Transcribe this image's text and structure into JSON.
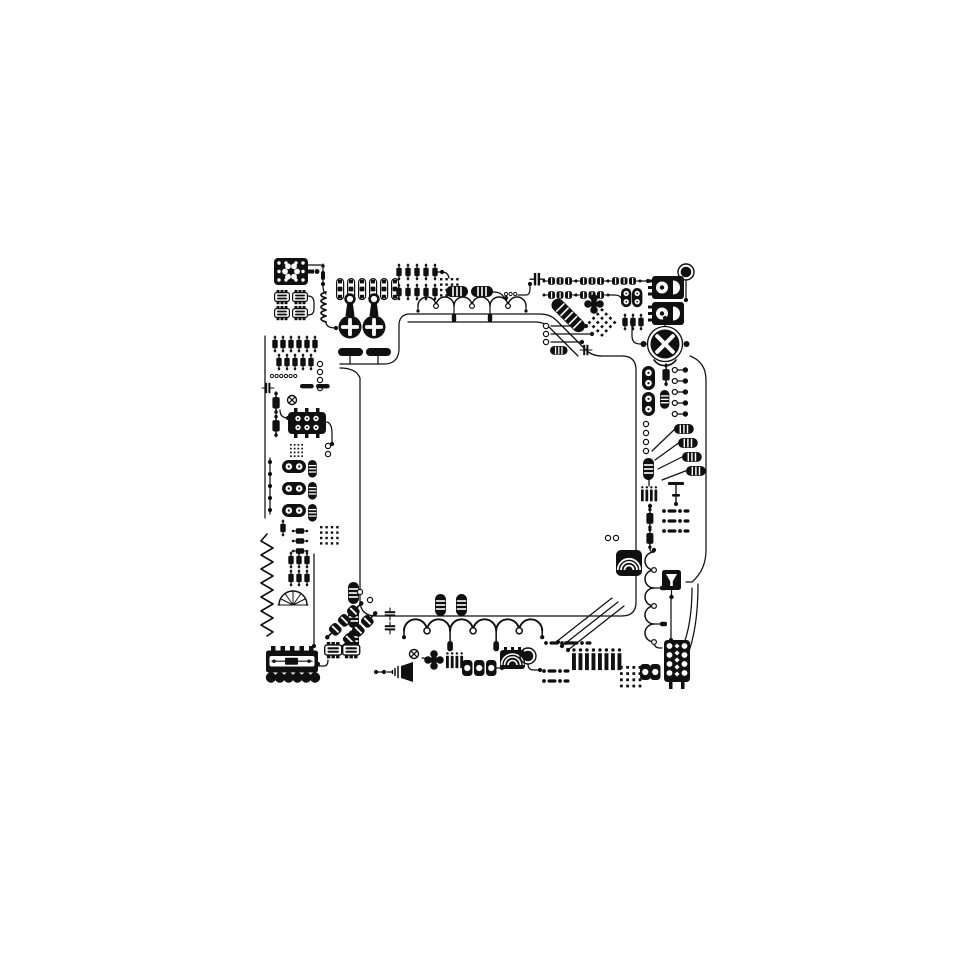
{
  "colors": {
    "ink": "#101010",
    "background": "#ffffff"
  },
  "diagram": {
    "frame": {
      "left": 256,
      "top": 252,
      "width": 456,
      "height": 448
    },
    "viewbox": "0 0 456 448",
    "components": [
      {
        "t": "ic-flower",
        "x": 18,
        "y": 6
      },
      {
        "t": "ic-small",
        "x": 18,
        "y": 38
      },
      {
        "t": "ic-small",
        "x": 36,
        "y": 38
      },
      {
        "t": "ic-small",
        "x": 18,
        "y": 54
      },
      {
        "t": "ic-small",
        "x": 36,
        "y": 54
      },
      {
        "t": "needle",
        "x": 64,
        "y": 12
      },
      {
        "t": "coil-v",
        "x": 62,
        "y": 40
      },
      {
        "t": "pin-pill",
        "x": 80,
        "y": 26
      },
      {
        "t": "pin-pill",
        "x": 91,
        "y": 26
      },
      {
        "t": "pin-pill",
        "x": 102,
        "y": 26
      },
      {
        "t": "pin-pill",
        "x": 113,
        "y": 26
      },
      {
        "t": "pin-pill",
        "x": 124,
        "y": 26
      },
      {
        "t": "pin-pill",
        "x": 135,
        "y": 26
      },
      {
        "t": "key-cross",
        "x": 86,
        "y": 42
      },
      {
        "t": "key-cross",
        "x": 110,
        "y": 42
      },
      {
        "t": "bar-h",
        "x": 82,
        "y": 96
      },
      {
        "t": "bar-h",
        "x": 110,
        "y": 96
      },
      {
        "t": "res-v",
        "x": 140,
        "y": 12
      },
      {
        "t": "res-v",
        "x": 149,
        "y": 12
      },
      {
        "t": "res-v",
        "x": 158,
        "y": 12
      },
      {
        "t": "res-v",
        "x": 167,
        "y": 12
      },
      {
        "t": "res-v",
        "x": 176,
        "y": 12
      },
      {
        "t": "res-v",
        "x": 140,
        "y": 32
      },
      {
        "t": "res-v",
        "x": 149,
        "y": 32
      },
      {
        "t": "res-v",
        "x": 158,
        "y": 32
      },
      {
        "t": "res-v",
        "x": 167,
        "y": 32
      },
      {
        "t": "res-v",
        "x": 176,
        "y": 32
      },
      {
        "t": "dot-grid",
        "x": 184,
        "y": 26
      },
      {
        "t": "pill-striped-h",
        "x": 190,
        "y": 34
      },
      {
        "t": "pill-striped-h",
        "x": 215,
        "y": 34
      },
      {
        "t": "wave6",
        "x": 162,
        "y": 44
      },
      {
        "t": "coo",
        "x": 250,
        "y": 42
      },
      {
        "t": "cap-h",
        "x": 274,
        "y": 20,
        "s": 1.2
      },
      {
        "t": "diode-chain",
        "x": 288,
        "y": 24
      },
      {
        "t": "diode-chain",
        "x": 320,
        "y": 24
      },
      {
        "t": "diode-chain",
        "x": 352,
        "y": 24
      },
      {
        "t": "diode-chain",
        "x": 288,
        "y": 38
      },
      {
        "t": "diode-chain",
        "x": 320,
        "y": 38
      },
      {
        "t": "clover5",
        "x": 338,
        "y": 52
      },
      {
        "t": "diag-cable",
        "x": 302,
        "y": 44,
        "r": 45
      },
      {
        "t": "dot-grid",
        "x": 346,
        "y": 56,
        "r": 45,
        "s": 1.1
      },
      {
        "t": "eight-v",
        "x": 365,
        "y": 36,
        "s": 0.8
      },
      {
        "t": "eight-v",
        "x": 376,
        "y": 36,
        "s": 0.8
      },
      {
        "t": "res-v",
        "x": 366,
        "y": 62
      },
      {
        "t": "res-v",
        "x": 374,
        "y": 62
      },
      {
        "t": "res-v",
        "x": 382,
        "y": 62
      },
      {
        "t": "ic-halfmoon",
        "x": 396,
        "y": 24
      },
      {
        "t": "ic-halfmoon",
        "x": 396,
        "y": 50
      },
      {
        "t": "big-dot",
        "x": 430,
        "y": 20
      },
      {
        "t": "ring",
        "x": 290,
        "y": 74
      },
      {
        "t": "ring",
        "x": 290,
        "y": 82
      },
      {
        "t": "ring",
        "x": 290,
        "y": 90
      },
      {
        "t": "pill-striped-h",
        "x": 294,
        "y": 94,
        "s": 0.8
      },
      {
        "t": "cap-h",
        "x": 324,
        "y": 92
      },
      {
        "t": "big-x",
        "x": 409,
        "y": 92
      },
      {
        "t": "ring-dot",
        "x": 416,
        "y": 114
      },
      {
        "t": "ring-dot",
        "x": 416,
        "y": 125
      },
      {
        "t": "ring-dot",
        "x": 416,
        "y": 136
      },
      {
        "t": "ring-dot",
        "x": 416,
        "y": 147
      },
      {
        "t": "ring-dot",
        "x": 416,
        "y": 158
      },
      {
        "t": "res-v",
        "x": 406,
        "y": 112,
        "s": 1.35
      },
      {
        "t": "pill-striped-v",
        "x": 404,
        "y": 138,
        "s": 0.85
      },
      {
        "t": "eight-v",
        "x": 386,
        "y": 114
      },
      {
        "t": "eight-v",
        "x": 386,
        "y": 140
      },
      {
        "t": "pill-striped-h",
        "x": 418,
        "y": 172,
        "s": 0.9
      },
      {
        "t": "pill-striped-h",
        "x": 422,
        "y": 186,
        "s": 0.9
      },
      {
        "t": "pill-striped-h",
        "x": 426,
        "y": 200,
        "s": 0.9
      },
      {
        "t": "pill-striped-h",
        "x": 430,
        "y": 214,
        "s": 0.9
      },
      {
        "t": "ring",
        "x": 390,
        "y": 172
      },
      {
        "t": "ring",
        "x": 390,
        "y": 181
      },
      {
        "t": "ring",
        "x": 390,
        "y": 190
      },
      {
        "t": "ring",
        "x": 390,
        "y": 199
      },
      {
        "t": "pill-striped-v",
        "x": 387,
        "y": 206
      },
      {
        "t": "stripes-v",
        "x": 385,
        "y": 234,
        "s": 0.9
      },
      {
        "t": "res-v",
        "x": 390,
        "y": 256,
        "s": 1.3
      },
      {
        "t": "res-v",
        "x": 390,
        "y": 276,
        "s": 1.3
      },
      {
        "t": "dash-dot-row",
        "x": 406,
        "y": 256
      },
      {
        "t": "dash-dot-row",
        "x": 406,
        "y": 266
      },
      {
        "t": "dash-dot-row",
        "x": 406,
        "y": 276
      },
      {
        "t": "cap-t",
        "x": 412,
        "y": 230
      },
      {
        "t": "wave5v",
        "x": 388,
        "y": 300
      },
      {
        "t": "shell",
        "x": 360,
        "y": 298
      },
      {
        "t": "ring",
        "x": 352,
        "y": 286
      },
      {
        "t": "ring",
        "x": 360,
        "y": 286
      },
      {
        "t": "funnel-ic",
        "x": 406,
        "y": 318
      },
      {
        "t": "relay-v",
        "x": 406,
        "y": 388
      },
      {
        "t": "zigzag-v",
        "x": 4,
        "y": 282
      },
      {
        "t": "res-v",
        "x": 32,
        "y": 300
      },
      {
        "t": "res-v",
        "x": 40,
        "y": 300
      },
      {
        "t": "res-v",
        "x": 48,
        "y": 300
      },
      {
        "t": "res-v",
        "x": 32,
        "y": 318
      },
      {
        "t": "res-v",
        "x": 40,
        "y": 318
      },
      {
        "t": "res-v",
        "x": 48,
        "y": 318
      },
      {
        "t": "semicircle-fan",
        "x": 22,
        "y": 336
      },
      {
        "t": "res-v",
        "x": 52,
        "y": 276,
        "r": 90
      },
      {
        "t": "res-v",
        "x": 52,
        "y": 286,
        "r": 90
      },
      {
        "t": "res-v",
        "x": 52,
        "y": 296,
        "r": 90
      },
      {
        "t": "pill-striped-v",
        "x": 92,
        "y": 330
      },
      {
        "t": "pill-striped-v",
        "x": 92,
        "y": 354
      },
      {
        "t": "pill-striped-v",
        "x": 92,
        "y": 378
      },
      {
        "t": "diode-chain",
        "x": 66,
        "y": 380,
        "r": -45,
        "s": 1.5
      },
      {
        "t": "diode-chain",
        "x": 80,
        "y": 390,
        "r": -45,
        "s": 1.5
      },
      {
        "t": "ring",
        "x": 104,
        "y": 340
      },
      {
        "t": "ring",
        "x": 114,
        "y": 348
      },
      {
        "t": "ic-small",
        "x": 68,
        "y": 390,
        "s": 1.15
      },
      {
        "t": "ic-small",
        "x": 86,
        "y": 390,
        "s": 1.15
      },
      {
        "t": "connector",
        "x": 10,
        "y": 394
      },
      {
        "t": "dot",
        "x": 128,
        "y": 420
      },
      {
        "t": "horn",
        "x": 136,
        "y": 410
      },
      {
        "t": "cap-h",
        "x": 140,
        "y": 356,
        "r": 90
      },
      {
        "t": "cap-h",
        "x": 140,
        "y": 370,
        "r": 90
      },
      {
        "t": "wave6",
        "x": 148,
        "y": 366,
        "s": 1.28
      },
      {
        "t": "pill-striped-v",
        "x": 179,
        "y": 342
      },
      {
        "t": "pill-striped-v",
        "x": 200,
        "y": 342
      },
      {
        "t": "x-ring",
        "x": 158,
        "y": 402
      },
      {
        "t": "clover5",
        "x": 178,
        "y": 408
      },
      {
        "t": "stripes-v",
        "x": 190,
        "y": 400,
        "s": 0.95
      },
      {
        "t": "oval-unit",
        "x": 206,
        "y": 408
      },
      {
        "t": "oval-unit",
        "x": 218,
        "y": 408
      },
      {
        "t": "oval-unit",
        "x": 230,
        "y": 408
      },
      {
        "t": "arc-box",
        "x": 244,
        "y": 398
      },
      {
        "t": "big-dot",
        "x": 272,
        "y": 404
      },
      {
        "t": "dash-dot-row",
        "x": 286,
        "y": 416
      },
      {
        "t": "dash-dot-row",
        "x": 286,
        "y": 426
      },
      {
        "t": "dash-dot-row",
        "x": 288,
        "y": 388
      },
      {
        "t": "dash-dot-row",
        "x": 308,
        "y": 388
      },
      {
        "t": "stripes-v",
        "x": 316,
        "y": 396,
        "s": 1.3
      },
      {
        "t": "stripes-v",
        "x": 342,
        "y": 396,
        "s": 1.3
      },
      {
        "t": "dot-grid",
        "x": 364,
        "y": 414,
        "s": 1.15
      },
      {
        "t": "oval-unit",
        "x": 384,
        "y": 412
      },
      {
        "t": "oval-unit",
        "x": 394,
        "y": 412
      },
      {
        "t": "res-v",
        "x": 16,
        "y": 84
      },
      {
        "t": "res-v",
        "x": 24,
        "y": 84
      },
      {
        "t": "res-v",
        "x": 32,
        "y": 84
      },
      {
        "t": "res-v",
        "x": 40,
        "y": 84
      },
      {
        "t": "res-v",
        "x": 48,
        "y": 84
      },
      {
        "t": "res-v",
        "x": 56,
        "y": 84
      },
      {
        "t": "res-v",
        "x": 20,
        "y": 102
      },
      {
        "t": "res-v",
        "x": 28,
        "y": 102
      },
      {
        "t": "res-v",
        "x": 36,
        "y": 102
      },
      {
        "t": "res-v",
        "x": 44,
        "y": 102
      },
      {
        "t": "res-v",
        "x": 52,
        "y": 102
      },
      {
        "t": "ring",
        "x": 64,
        "y": 112
      },
      {
        "t": "ring",
        "x": 64,
        "y": 120
      },
      {
        "t": "ring",
        "x": 64,
        "y": 128
      },
      {
        "t": "ring",
        "x": 64,
        "y": 136
      },
      {
        "t": "coo",
        "x": 16,
        "y": 124
      },
      {
        "t": "coo",
        "x": 30,
        "y": 124
      },
      {
        "t": "cap-h",
        "x": 6,
        "y": 130
      },
      {
        "t": "bar-h",
        "x": 44,
        "y": 132,
        "s": 0.55
      },
      {
        "t": "bar-h",
        "x": 60,
        "y": 132,
        "s": 0.55
      },
      {
        "t": "x-ring",
        "x": 36,
        "y": 148
      },
      {
        "t": "res-v",
        "x": 16,
        "y": 140,
        "s": 1.35
      },
      {
        "t": "res-v",
        "x": 16,
        "y": 163,
        "s": 1.35
      },
      {
        "t": "relay-h",
        "x": 32,
        "y": 158
      },
      {
        "t": "dot-grid",
        "x": 34,
        "y": 192,
        "s": 0.7
      },
      {
        "t": "ring",
        "x": 72,
        "y": 194
      },
      {
        "t": "ring",
        "x": 72,
        "y": 202
      },
      {
        "t": "eight-h",
        "x": 26,
        "y": 208
      },
      {
        "t": "eight-h",
        "x": 26,
        "y": 230
      },
      {
        "t": "eight-h",
        "x": 26,
        "y": 252
      },
      {
        "t": "pill-striped-v",
        "x": 52,
        "y": 208,
        "s": 0.8
      },
      {
        "t": "pill-striped-v",
        "x": 52,
        "y": 230,
        "s": 0.8
      },
      {
        "t": "pill-striped-v",
        "x": 52,
        "y": 252,
        "s": 0.8
      },
      {
        "t": "dot",
        "x": 14,
        "y": 210
      },
      {
        "t": "dot",
        "x": 14,
        "y": 222
      },
      {
        "t": "dot",
        "x": 14,
        "y": 234
      },
      {
        "t": "dot",
        "x": 14,
        "y": 246
      },
      {
        "t": "dot",
        "x": 14,
        "y": 258
      },
      {
        "t": "dot-grid",
        "x": 64,
        "y": 274
      },
      {
        "t": "res-v",
        "x": 24,
        "y": 268
      }
    ],
    "wires": [
      {
        "d": "M84,116 Q100,116 104,126 V348 Q104,364 120,364 H366 Q380,364 380,350 V118 Q380,104 366,104 H346 Q336,104 330,98 L300,68 Q294,62 284,62 H154 Q144,62 143,72 V98 Q142,112 128,112 H84"
      },
      {
        "d": "M152,70 H280 Q288,70 294,76 L322,104"
      },
      {
        "d": "M48,13 H67"
      },
      {
        "d": "M67,34 Q67,40 70,42"
      },
      {
        "d": "M70,70 Q70,76 80,76"
      },
      {
        "d": "M52,44 Q58,44 58,51 V57 Q58,63 52,63"
      },
      {
        "d": "M178,20 H186"
      },
      {
        "d": "M186,20 Q192,20 193,26"
      },
      {
        "d": "M237,40 Q246,40 248,46 H250"
      },
      {
        "d": "M262,43 H270 Q274,43 274,36 V32"
      },
      {
        "d": "M318,29 H320"
      },
      {
        "d": "M350,29 H352"
      },
      {
        "d": "M318,43 H320"
      },
      {
        "d": "M352,43 H358 Q364,43 365,46"
      },
      {
        "d": "M382,29 H392"
      },
      {
        "d": "M430,28 V46"
      },
      {
        "d": "M391,92 H384 Q376,92 376,84 V72"
      },
      {
        "d": "M434,104 Q450,110 450,128 V298 Q450,318 436,330 H430"
      },
      {
        "d": "M295,74 H330"
      },
      {
        "d": "M295,82 H336"
      },
      {
        "d": "M295,90 H326"
      },
      {
        "d": "M420,176 L396,199"
      },
      {
        "d": "M424,190 L399,208"
      },
      {
        "d": "M428,204 L402,217"
      },
      {
        "d": "M432,218 L406,228"
      },
      {
        "d": "M393,228 V234"
      },
      {
        "d": "M394,252 V256"
      },
      {
        "d": "M394,297 Q394,300 398,300"
      },
      {
        "d": "M415,347 V386"
      },
      {
        "d": "M398,390 Q398,396 404,396 H406"
      },
      {
        "d": "M442,332 Q442,402 416,428"
      },
      {
        "d": "M436,336 Q436,396 410,420"
      },
      {
        "d": "M300,390 L356,346"
      },
      {
        "d": "M306,394 L362,350"
      },
      {
        "d": "M312,398 L368,354"
      },
      {
        "d": "M62,414 H68 Q72,414 72,408"
      },
      {
        "d": "M120,420 H128"
      },
      {
        "d": "M166,406 Q170,406 172,408"
      },
      {
        "d": "M240,416 H246"
      },
      {
        "d": "M272,412 Q272,418 278,418 H284"
      },
      {
        "d": "M9,84 V266"
      },
      {
        "d": "M14,206 V262"
      },
      {
        "d": "M24,158 Q24,166 32,166"
      },
      {
        "d": "M70,170 Q76,170 76,182 V192"
      },
      {
        "d": "M58,302 V392"
      },
      {
        "d": "M94,104 V112"
      },
      {
        "d": "M122,104 V112"
      },
      {
        "d": "M409,74 V68"
      }
    ],
    "dots": [
      [
        67,
        32
      ],
      [
        80,
        76
      ],
      [
        250,
        46
      ],
      [
        274,
        32
      ],
      [
        392,
        29
      ],
      [
        430,
        48
      ],
      [
        376,
        70
      ],
      [
        394,
        254
      ],
      [
        398,
        298
      ],
      [
        415,
        388
      ],
      [
        62,
        412
      ],
      [
        120,
        420
      ],
      [
        246,
        416
      ],
      [
        284,
        418
      ],
      [
        32,
        166
      ],
      [
        76,
        192
      ],
      [
        58,
        394
      ],
      [
        186,
        20
      ],
      [
        302,
        390
      ],
      [
        306,
        394
      ],
      [
        312,
        398
      ],
      [
        330,
        74
      ],
      [
        336,
        82
      ],
      [
        326,
        90
      ],
      [
        409,
        66
      ]
    ]
  }
}
